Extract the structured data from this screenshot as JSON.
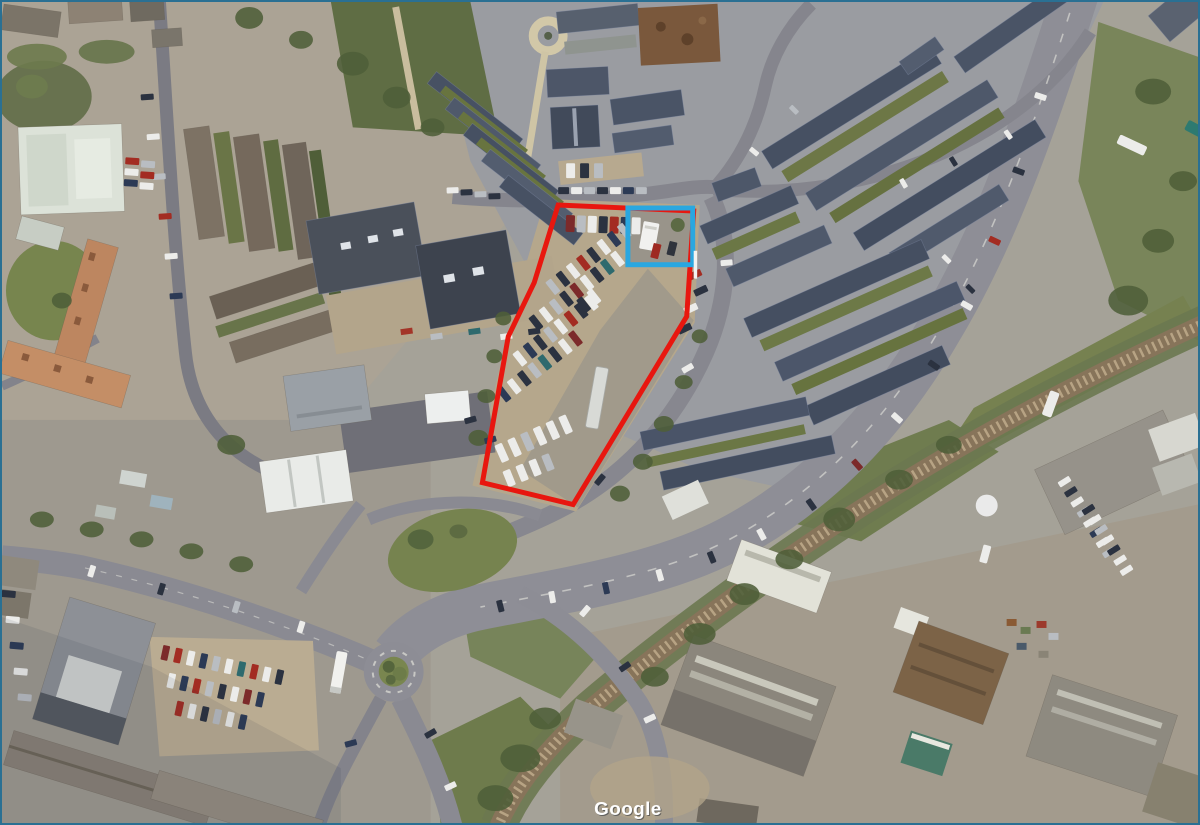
{
  "frame": {
    "css": "border:2px solid #2a7093",
    "width": 1200,
    "height": 825
  },
  "map": {
    "type": "satellite-aerial",
    "description": "Aerial town view with annotated site boundary and highlighted building"
  },
  "watermark": {
    "text": "Google"
  },
  "annotations": {
    "site_boundary": {
      "shape": "polygon",
      "color": "#e8170f",
      "stroke_width": 5,
      "points": "558,204 694,210 687,316 573,505 482,483 508,336 534,282"
    },
    "highlight_box": {
      "shape": "rect",
      "color": "#2aa7e0",
      "stroke_width": 5,
      "x": 628,
      "y": 207,
      "width": 65,
      "height": 57
    }
  }
}
